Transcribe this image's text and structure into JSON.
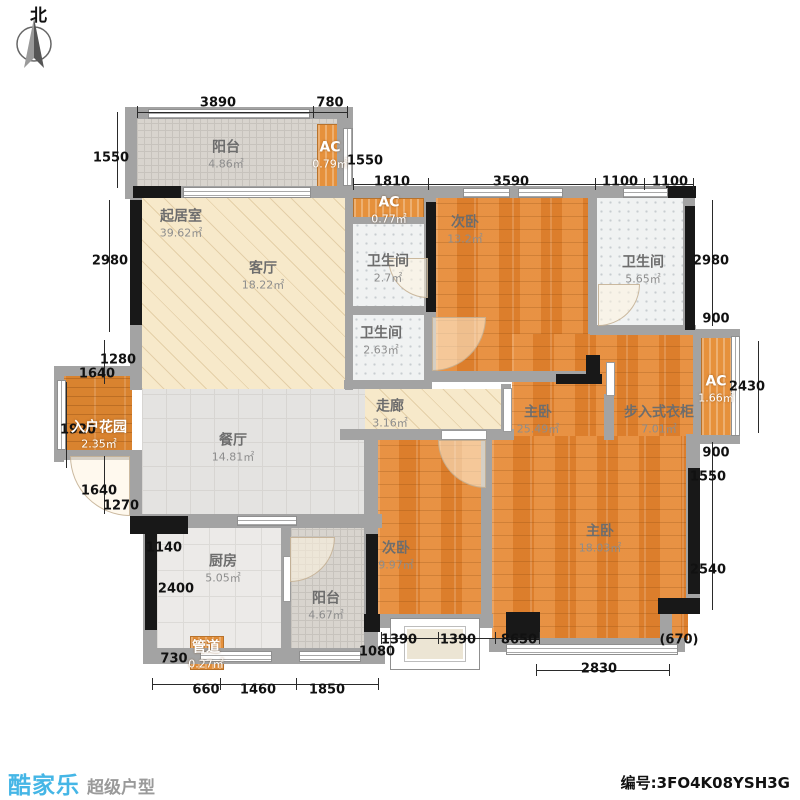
{
  "north": {
    "label": "北"
  },
  "footer": {
    "brand": "酷家乐",
    "tagline": "超级户型",
    "serial": "编号:3FO4K08YSH3G",
    "brand_color": "#45b6e6"
  },
  "plan": {
    "areas": [
      {
        "id": "balcony-top-floor",
        "fill": "balc",
        "x": 137,
        "y": 119,
        "w": 202,
        "h": 68
      },
      {
        "id": "ac-top-unit",
        "fill": "ac",
        "x": 317,
        "y": 124,
        "w": 27,
        "h": 63
      },
      {
        "id": "living-floor",
        "fill": "hatch",
        "x": 142,
        "y": 198,
        "w": 203,
        "h": 191
      },
      {
        "id": "ac-mid-unit",
        "fill": "ac",
        "x": 353,
        "y": 198,
        "w": 71,
        "h": 21
      },
      {
        "id": "bath1-floor",
        "fill": "bath",
        "x": 353,
        "y": 221,
        "w": 71,
        "h": 85
      },
      {
        "id": "bath2-floor",
        "fill": "bath",
        "x": 352,
        "y": 315,
        "w": 72,
        "h": 66
      },
      {
        "id": "bedroom2a-floor",
        "fill": "wood",
        "x": 436,
        "y": 198,
        "w": 152,
        "h": 175
      },
      {
        "id": "bath3-floor",
        "fill": "bath",
        "x": 597,
        "y": 198,
        "w": 86,
        "h": 127
      },
      {
        "id": "master-upper-floor",
        "fill": "wood",
        "x": 512,
        "y": 334,
        "w": 181,
        "h": 104
      },
      {
        "id": "ac-right-unit",
        "fill": "ac",
        "x": 701,
        "y": 333,
        "w": 32,
        "h": 103
      },
      {
        "id": "corridor-floor",
        "fill": "hatch",
        "x": 356,
        "y": 389,
        "w": 156,
        "h": 41
      },
      {
        "id": "entry-garden-floor",
        "fill": "woodh",
        "x": 64,
        "y": 376,
        "w": 68,
        "h": 75
      },
      {
        "id": "dining-floor",
        "fill": "tile",
        "x": 142,
        "y": 389,
        "w": 223,
        "h": 126
      },
      {
        "id": "kitchen-floor",
        "fill": "ktile",
        "x": 157,
        "y": 528,
        "w": 125,
        "h": 121
      },
      {
        "id": "balcony-bottom-floor",
        "fill": "balc",
        "x": 291,
        "y": 528,
        "w": 74,
        "h": 121
      },
      {
        "id": "bedroom2b-floor",
        "fill": "wood",
        "x": 378,
        "y": 440,
        "w": 104,
        "h": 175
      },
      {
        "id": "master-lower-floor",
        "fill": "wood",
        "x": 492,
        "y": 436,
        "w": 196,
        "h": 204
      },
      {
        "id": "pipe-duct-box",
        "fill": "ac",
        "x": 190,
        "y": 636,
        "w": 34,
        "h": 34
      }
    ],
    "labels": [
      {
        "id": "balcony-top",
        "name": "阳台",
        "area": "4.86㎡",
        "x": 226,
        "y": 155
      },
      {
        "id": "ac-top",
        "name": "AC",
        "area": "0.79㎡",
        "x": 330,
        "y": 155,
        "light": true
      },
      {
        "id": "living-room",
        "name": "起居室",
        "area": "39.62㎡",
        "x": 181,
        "y": 224
      },
      {
        "id": "living-hall",
        "name": "客厅",
        "area": "18.22㎡",
        "x": 263,
        "y": 276
      },
      {
        "id": "ac-mid",
        "name": "AC",
        "area": "0.77㎡",
        "x": 389,
        "y": 210,
        "light": true
      },
      {
        "id": "bath-1",
        "name": "卫生间",
        "area": "2.7㎡",
        "x": 388,
        "y": 269
      },
      {
        "id": "bath-2",
        "name": "卫生间",
        "area": "2.63㎡",
        "x": 381,
        "y": 341
      },
      {
        "id": "bedroom-2a",
        "name": "次卧",
        "area": "13.2㎡",
        "x": 465,
        "y": 230
      },
      {
        "id": "bath-3",
        "name": "卫生间",
        "area": "5.65㎡",
        "x": 643,
        "y": 270
      },
      {
        "id": "master-suite",
        "name": "主卧",
        "area": "25.49㎡",
        "x": 538,
        "y": 420
      },
      {
        "id": "walkin-closet",
        "name": "步入式衣柜",
        "area": "7.01㎡",
        "x": 659,
        "y": 420
      },
      {
        "id": "ac-right",
        "name": "AC",
        "area": "1.66㎡",
        "x": 716,
        "y": 389,
        "light": true
      },
      {
        "id": "corridor",
        "name": "走廊",
        "area": "3.16㎡",
        "x": 390,
        "y": 414
      },
      {
        "id": "entry-garden",
        "name": "入户花园",
        "area": "2.35㎡",
        "x": 99,
        "y": 435,
        "light": true
      },
      {
        "id": "dining",
        "name": "餐厅",
        "area": "14.81㎡",
        "x": 233,
        "y": 448
      },
      {
        "id": "kitchen",
        "name": "厨房",
        "area": "5.05㎡",
        "x": 223,
        "y": 569
      },
      {
        "id": "balcony-bottom",
        "name": "阳台",
        "area": "4.67㎡",
        "x": 326,
        "y": 606
      },
      {
        "id": "pipe-duct",
        "name": "管道",
        "area": "0.27㎡",
        "x": 206,
        "y": 655,
        "light": true
      },
      {
        "id": "bedroom-2b",
        "name": "次卧",
        "area": "9.97㎡",
        "x": 396,
        "y": 556
      },
      {
        "id": "master-bedroom",
        "name": "主卧",
        "area": "18.03㎡",
        "x": 600,
        "y": 539
      }
    ],
    "walls": [
      [
        125,
        107,
        228,
        12
      ],
      [
        125,
        107,
        12,
        92
      ],
      [
        337,
        112,
        8,
        80
      ],
      [
        343,
        107,
        10,
        85
      ],
      [
        130,
        186,
        217,
        12
      ],
      [
        130,
        198,
        12,
        192
      ],
      [
        345,
        186,
        350,
        12
      ],
      [
        345,
        198,
        8,
        192
      ],
      [
        424,
        198,
        12,
        184
      ],
      [
        588,
        198,
        9,
        136
      ],
      [
        683,
        198,
        12,
        136
      ],
      [
        590,
        325,
        106,
        10
      ],
      [
        693,
        329,
        47,
        9
      ],
      [
        693,
        435,
        47,
        9
      ],
      [
        693,
        334,
        8,
        102
      ],
      [
        348,
        217,
        78,
        7
      ],
      [
        346,
        306,
        82,
        9
      ],
      [
        344,
        380,
        88,
        9
      ],
      [
        424,
        371,
        170,
        11
      ],
      [
        340,
        429,
        174,
        11
      ],
      [
        56,
        366,
        84,
        10
      ],
      [
        54,
        366,
        10,
        96
      ],
      [
        56,
        450,
        84,
        10
      ],
      [
        130,
        450,
        12,
        78
      ],
      [
        130,
        514,
        252,
        14
      ],
      [
        143,
        528,
        14,
        130
      ],
      [
        143,
        648,
        242,
        16
      ],
      [
        281,
        528,
        10,
        126
      ],
      [
        364,
        430,
        14,
        100
      ],
      [
        364,
        528,
        14,
        128
      ],
      [
        481,
        434,
        11,
        192
      ],
      [
        373,
        614,
        120,
        14
      ],
      [
        489,
        638,
        196,
        14
      ],
      [
        686,
        434,
        14,
        176
      ],
      [
        660,
        610,
        12,
        38
      ],
      [
        501,
        384,
        10,
        48
      ],
      [
        604,
        394,
        10,
        46
      ]
    ],
    "black_walls": [
      [
        133,
        186,
        48,
        12
      ],
      [
        130,
        200,
        12,
        125
      ],
      [
        426,
        202,
        10,
        110
      ],
      [
        666,
        186,
        30,
        12
      ],
      [
        685,
        206,
        10,
        124
      ],
      [
        586,
        355,
        14,
        28
      ],
      [
        556,
        374,
        46,
        10
      ],
      [
        130,
        516,
        58,
        18
      ],
      [
        145,
        532,
        12,
        98
      ],
      [
        366,
        534,
        12,
        96
      ],
      [
        688,
        468,
        12,
        126
      ],
      [
        658,
        598,
        42,
        16
      ],
      [
        364,
        614,
        16,
        18
      ],
      [
        506,
        612,
        34,
        28
      ]
    ],
    "windows": [
      [
        148,
        109,
        162,
        10,
        "h"
      ],
      [
        183,
        187,
        128,
        11,
        "h"
      ],
      [
        343,
        128,
        10,
        58,
        "v"
      ],
      [
        463,
        188,
        47,
        10,
        "h"
      ],
      [
        518,
        188,
        45,
        10,
        "h"
      ],
      [
        623,
        188,
        45,
        10,
        "h"
      ],
      [
        731,
        336,
        9,
        100,
        "v"
      ],
      [
        57,
        380,
        9,
        70,
        "v"
      ],
      [
        237,
        516,
        60,
        10,
        "h"
      ],
      [
        200,
        651,
        72,
        11,
        "h"
      ],
      [
        299,
        651,
        62,
        11,
        "h"
      ],
      [
        506,
        644,
        172,
        11,
        "h"
      ]
    ],
    "door_leaves": [
      [
        503,
        388,
        9,
        44
      ],
      [
        606,
        362,
        9,
        34
      ],
      [
        283,
        556,
        8,
        46
      ],
      [
        441,
        430,
        46,
        10
      ]
    ],
    "doors": [
      {
        "x": 70,
        "y": 456,
        "s": 60,
        "c": "bl"
      },
      {
        "x": 432,
        "y": 317,
        "s": 54,
        "c": "br"
      },
      {
        "x": 438,
        "y": 440,
        "s": 48,
        "c": "bl"
      },
      {
        "x": 388,
        "y": 258,
        "s": 40,
        "c": "bl"
      },
      {
        "x": 598,
        "y": 284,
        "s": 42,
        "c": "br"
      },
      {
        "x": 290,
        "y": 537,
        "s": 45,
        "c": "br"
      }
    ],
    "bay_window": {
      "x": 390,
      "y": 618,
      "w": 90,
      "h": 52
    },
    "dims": [
      {
        "v": "3890",
        "x": 218,
        "y": 103
      },
      {
        "v": "780",
        "x": 330,
        "y": 103
      },
      {
        "v": "1550",
        "x": 111,
        "y": 158
      },
      {
        "v": "1550",
        "x": 365,
        "y": 161
      },
      {
        "v": "1810",
        "x": 392,
        "y": 182
      },
      {
        "v": "3590",
        "x": 511,
        "y": 182
      },
      {
        "v": "1100",
        "x": 620,
        "y": 182
      },
      {
        "v": "1100",
        "x": 670,
        "y": 182
      },
      {
        "v": "2980",
        "x": 110,
        "y": 261
      },
      {
        "v": "1280",
        "x": 118,
        "y": 360
      },
      {
        "v": "1640",
        "x": 97,
        "y": 374
      },
      {
        "v": "1920",
        "x": 78,
        "y": 430
      },
      {
        "v": "1640",
        "x": 99,
        "y": 491
      },
      {
        "v": "1270",
        "x": 121,
        "y": 506
      },
      {
        "v": "1140",
        "x": 164,
        "y": 548
      },
      {
        "v": "2400",
        "x": 176,
        "y": 589
      },
      {
        "v": "730",
        "x": 174,
        "y": 659
      },
      {
        "v": "660",
        "x": 206,
        "y": 690
      },
      {
        "v": "1460",
        "x": 258,
        "y": 690
      },
      {
        "v": "1850",
        "x": 327,
        "y": 690
      },
      {
        "v": "1080",
        "x": 377,
        "y": 652
      },
      {
        "v": "1390",
        "x": 399,
        "y": 640
      },
      {
        "v": "1390",
        "x": 458,
        "y": 640
      },
      {
        "v": "8650",
        "x": 519,
        "y": 640
      },
      {
        "v": "2830",
        "x": 599,
        "y": 669
      },
      {
        "v": "(670)",
        "x": 679,
        "y": 640
      },
      {
        "v": "2980",
        "x": 711,
        "y": 261
      },
      {
        "v": "900",
        "x": 716,
        "y": 319
      },
      {
        "v": "2430",
        "x": 747,
        "y": 387
      },
      {
        "v": "900",
        "x": 716,
        "y": 453
      },
      {
        "v": "1550",
        "x": 708,
        "y": 477
      },
      {
        "v": "2540",
        "x": 708,
        "y": 570
      }
    ],
    "dim_lines": [
      [
        137,
        112,
        210,
        1
      ],
      [
        137,
        106,
        1,
        12
      ],
      [
        313,
        106,
        1,
        12
      ],
      [
        347,
        106,
        1,
        12
      ],
      [
        353,
        184,
        341,
        1
      ],
      [
        353,
        178,
        1,
        12
      ],
      [
        428,
        178,
        1,
        12
      ],
      [
        595,
        178,
        1,
        12
      ],
      [
        644,
        178,
        1,
        12
      ],
      [
        693,
        178,
        1,
        12
      ],
      [
        117,
        112,
        1,
        76
      ],
      [
        109,
        200,
        1,
        132
      ],
      [
        66,
        382,
        1,
        86
      ],
      [
        104,
        340,
        1,
        44
      ],
      [
        104,
        456,
        1,
        58
      ],
      [
        152,
        684,
        226,
        1
      ],
      [
        152,
        678,
        1,
        12
      ],
      [
        220,
        678,
        1,
        12
      ],
      [
        296,
        678,
        1,
        12
      ],
      [
        378,
        678,
        1,
        12
      ],
      [
        381,
        638,
        158,
        1
      ],
      [
        381,
        632,
        1,
        12
      ],
      [
        438,
        632,
        1,
        12
      ],
      [
        495,
        632,
        1,
        12
      ],
      [
        539,
        632,
        1,
        12
      ],
      [
        536,
        670,
        133,
        1
      ],
      [
        536,
        664,
        1,
        12
      ],
      [
        669,
        664,
        1,
        12
      ],
      [
        712,
        200,
        1,
        126
      ],
      [
        758,
        341,
        1,
        92
      ],
      [
        712,
        442,
        1,
        168
      ]
    ]
  }
}
